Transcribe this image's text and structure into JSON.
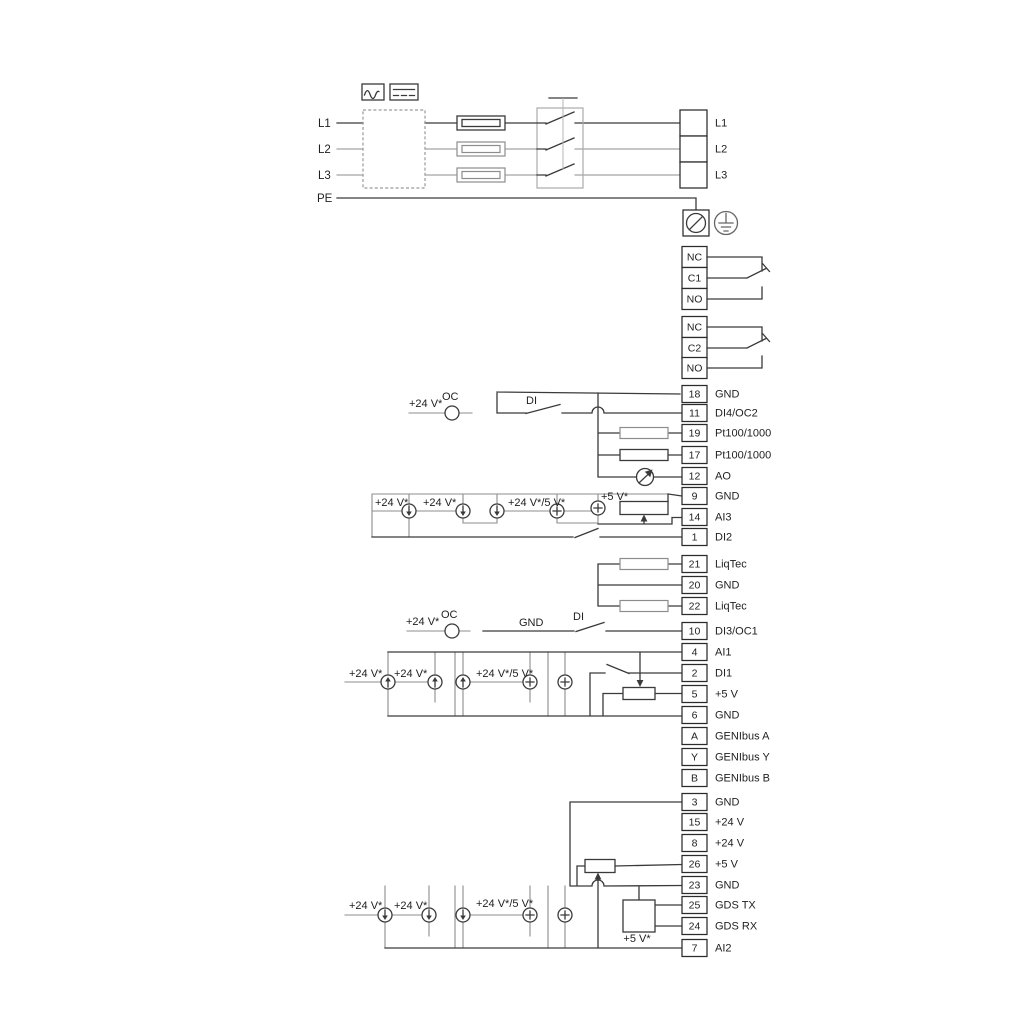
{
  "power": {
    "input_labels": [
      "L1",
      "L2",
      "L3",
      "PE"
    ],
    "icons": {
      "ac_symbol": "ac-waveform-icon",
      "dc_symbol": "dc-symbol-icon",
      "fuse": "fuse-icon",
      "switch": "main-disconnect-switch",
      "screw_terminal": "pe-screw-terminal-icon",
      "earth": "earth-ground-icon"
    }
  },
  "terminals": {
    "top_block": [
      "L1",
      "L2",
      "L3"
    ],
    "relay1": [
      "NC",
      "C1",
      "NO"
    ],
    "relay2": [
      "NC",
      "C2",
      "NO"
    ],
    "group1": [
      {
        "no": "18",
        "label": "GND"
      },
      {
        "no": "11",
        "label": "DI4/OC2"
      },
      {
        "no": "19",
        "label": "Pt100/1000"
      },
      {
        "no": "17",
        "label": "Pt100/1000"
      },
      {
        "no": "12",
        "label": "AO"
      },
      {
        "no": "9",
        "label": "GND"
      },
      {
        "no": "14",
        "label": "AI3"
      },
      {
        "no": "1",
        "label": "DI2"
      }
    ],
    "group2": [
      {
        "no": "21",
        "label": "LiqTec"
      },
      {
        "no": "20",
        "label": "GND"
      },
      {
        "no": "22",
        "label": "LiqTec"
      }
    ],
    "group3": [
      {
        "no": "10",
        "label": "DI3/OC1"
      },
      {
        "no": "4",
        "label": "AI1"
      },
      {
        "no": "2",
        "label": "DI1"
      },
      {
        "no": "5",
        "label": "+5 V"
      },
      {
        "no": "6",
        "label": "GND"
      },
      {
        "no": "A",
        "label": "GENIbus A"
      },
      {
        "no": "Y",
        "label": "GENIbus Y"
      },
      {
        "no": "B",
        "label": "GENIbus B"
      }
    ],
    "group4": [
      {
        "no": "3",
        "label": "GND"
      },
      {
        "no": "15",
        "label": "+24 V"
      },
      {
        "no": "8",
        "label": "+24 V"
      },
      {
        "no": "26",
        "label": "+5 V"
      },
      {
        "no": "23",
        "label": "GND"
      },
      {
        "no": "25",
        "label": "GDS TX"
      },
      {
        "no": "24",
        "label": "GDS RX"
      },
      {
        "no": "7",
        "label": "AI2"
      }
    ]
  },
  "annotations": {
    "v24": "+24 V*",
    "v24_5": "+24 V*/5 V*",
    "v5": "+5 V*",
    "oc": "OC",
    "di": "DI",
    "gnd": "GND"
  },
  "colors": {
    "line": "#3a3a3a",
    "option": "#8d8d8d",
    "text": "#1f1f1f"
  }
}
